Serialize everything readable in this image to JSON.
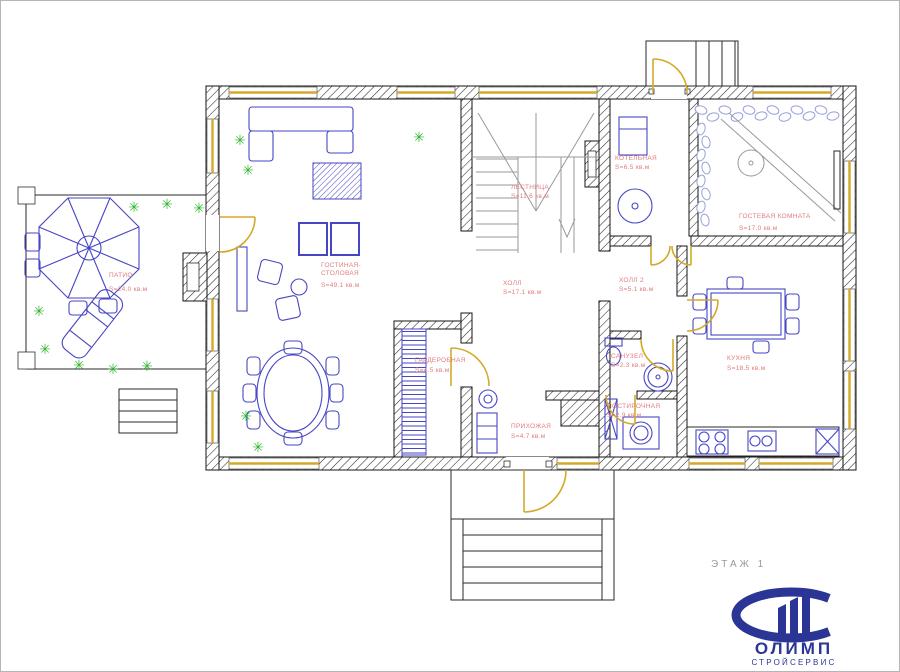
{
  "floor_label": "ЭТАЖ 1",
  "logo": {
    "name": "ОЛИМП",
    "subtitle": "СТРОЙСЕРВИС"
  },
  "icons": {
    "plant": "✳"
  },
  "colors": {
    "wall": "#151515",
    "door": "#d4a829",
    "furniture": "#4646c4",
    "plant": "#2db52d",
    "label": "#e07d7d",
    "stairs": "#9a9a9a",
    "logo": "#2b3595",
    "pebble": "#98a0da",
    "floor_text": "#9a9a9a"
  },
  "rooms": [
    {
      "id": "patio",
      "name": "ПАТИО",
      "area": "S=24.0 кв.м"
    },
    {
      "id": "living-dining",
      "name": "ГОСТИНАЯ-",
      "name2": "СТОЛОВАЯ",
      "area": "S=49.1 кв.м"
    },
    {
      "id": "stairs",
      "name": "ЛЕСТНИЦА",
      "area": "S=11.6 кв.м"
    },
    {
      "id": "hall",
      "name": "ХОЛЛ",
      "area": "S=17.1 кв.м"
    },
    {
      "id": "boiler-room",
      "name": "КОТЕЛЬНАЯ",
      "area": "S=6.5 кв.м"
    },
    {
      "id": "guest-room",
      "name": "ГОСТЕВАЯ КОМНАТА",
      "area": "S=17.0 кв.м"
    },
    {
      "id": "hall-2",
      "name": "ХОЛЛ 2",
      "area": "S=5.1 кв.м"
    },
    {
      "id": "bathroom",
      "name": "САНУЗЕЛ",
      "area": "S=2.3 кв.м"
    },
    {
      "id": "laundry",
      "name": "ПОСТИРОЧНАЯ",
      "area": "S=2.9 кв.м"
    },
    {
      "id": "kitchen",
      "name": "КУХНЯ",
      "area": "S=18.5 кв.м"
    },
    {
      "id": "wardrobe",
      "name": "ГАРДЕРОБНАЯ",
      "area": "S=4.5 кв.м"
    },
    {
      "id": "entry-hall",
      "name": "ПРИХОЖАЯ",
      "area": "S=4.7 кв.м"
    }
  ]
}
